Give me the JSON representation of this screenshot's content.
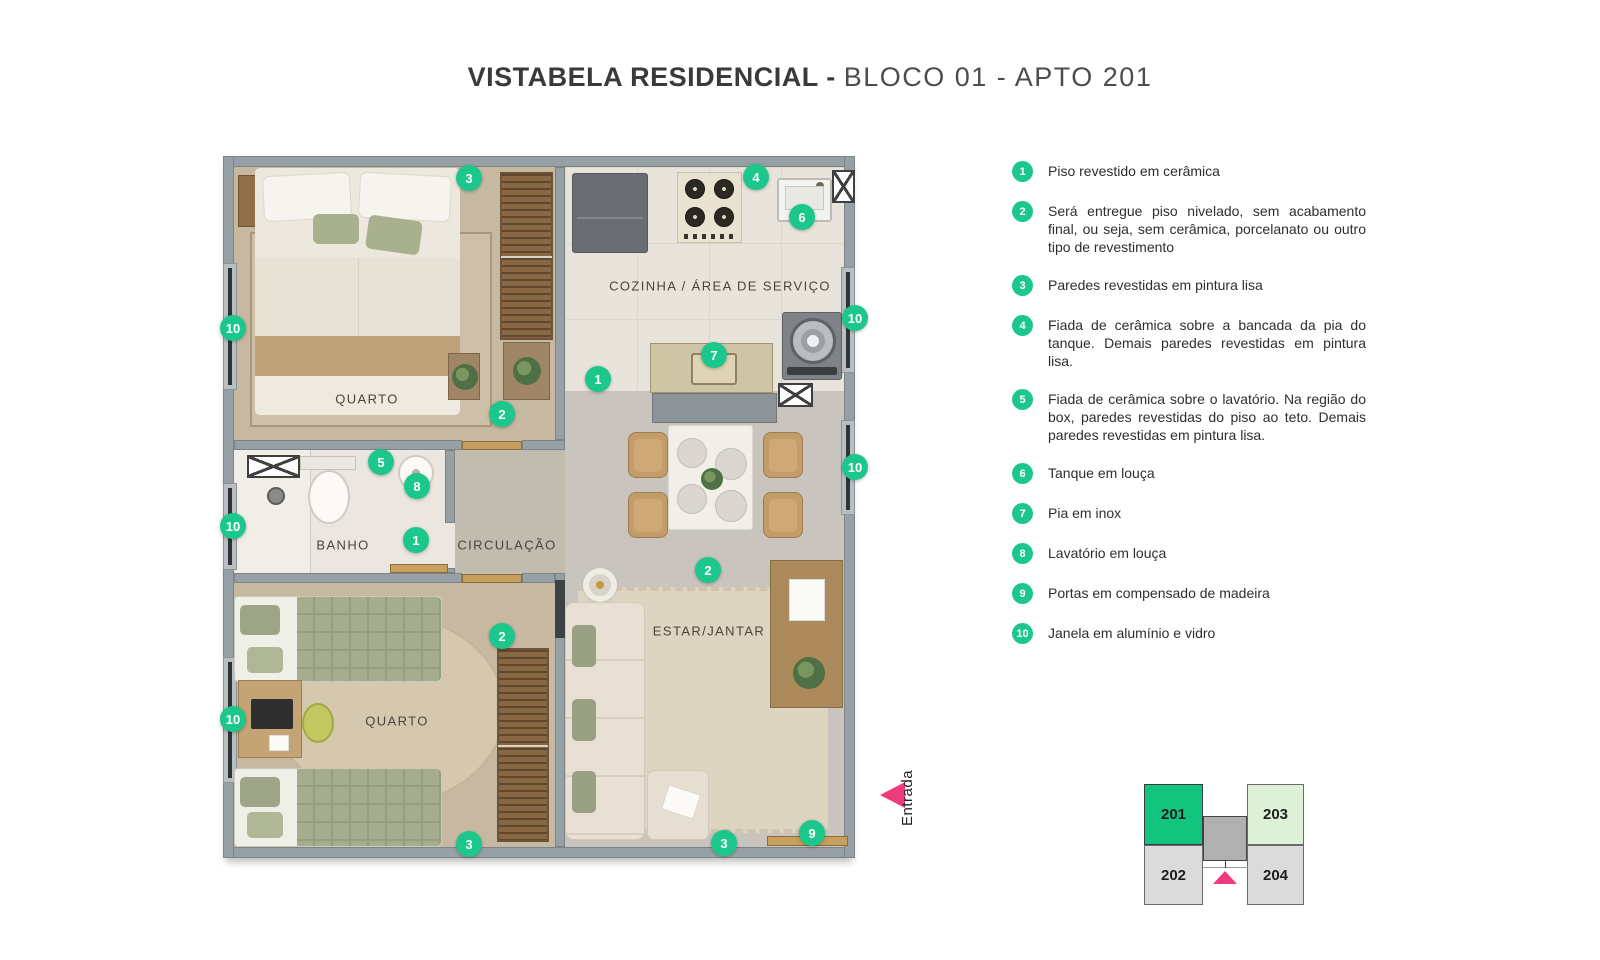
{
  "title": {
    "main": "VISTABELA RESIDENCIAL -",
    "sub": "BLOCO 01 - APTO 201"
  },
  "colors": {
    "accent_green": "#1cc78c",
    "accent_pink": "#ee3b7e",
    "unit_active": "#13c47f",
    "unit_soft": "#def0d5"
  },
  "plan": {
    "entrance_label": "Entrada",
    "rooms": [
      {
        "label": "QUARTO",
        "x": 144,
        "y": 243
      },
      {
        "label": "COZINHA / ÁREA DE SERVIÇO",
        "x": 497,
        "y": 130
      },
      {
        "label": "BANHO",
        "x": 120,
        "y": 389
      },
      {
        "label": "CIRCULAÇÃO",
        "x": 284,
        "y": 389
      },
      {
        "label": "QUARTO",
        "x": 174,
        "y": 565
      },
      {
        "label": "ESTAR/JANTAR",
        "x": 486,
        "y": 475
      }
    ],
    "badges": [
      {
        "n": "3",
        "x": 246,
        "y": 22
      },
      {
        "n": "4",
        "x": 533,
        "y": 21
      },
      {
        "n": "6",
        "x": 579,
        "y": 61
      },
      {
        "n": "10",
        "x": 632,
        "y": 162
      },
      {
        "n": "7",
        "x": 491,
        "y": 199
      },
      {
        "n": "1",
        "x": 375,
        "y": 223
      },
      {
        "n": "2",
        "x": 279,
        "y": 258
      },
      {
        "n": "10",
        "x": 10,
        "y": 172
      },
      {
        "n": "5",
        "x": 158,
        "y": 306
      },
      {
        "n": "8",
        "x": 194,
        "y": 330
      },
      {
        "n": "10",
        "x": 10,
        "y": 370
      },
      {
        "n": "1",
        "x": 193,
        "y": 384
      },
      {
        "n": "10",
        "x": 632,
        "y": 311
      },
      {
        "n": "2",
        "x": 485,
        "y": 414
      },
      {
        "n": "2",
        "x": 279,
        "y": 480
      },
      {
        "n": "10",
        "x": 10,
        "y": 563
      },
      {
        "n": "3",
        "x": 246,
        "y": 688
      },
      {
        "n": "3",
        "x": 501,
        "y": 687
      },
      {
        "n": "9",
        "x": 589,
        "y": 677
      }
    ]
  },
  "legend": {
    "items": [
      {
        "n": "1",
        "text": "Piso revestido em cerâmica"
      },
      {
        "n": "2",
        "text": "Será entregue piso nivelado, sem acabamento final, ou seja, sem cerâmica, porcelanato ou outro tipo de revestimento"
      },
      {
        "n": "3",
        "text": "Paredes revestidas em pintura lisa"
      },
      {
        "n": "4",
        "text": "Fiada de cerâmica sobre a bancada da pia do tanque. Demais paredes revestidas em pintura lisa."
      },
      {
        "n": "5",
        "text": "Fiada de cerâmica sobre o lavatório. Na região do box, paredes revestidas do piso ao teto. Demais paredes revestidas em pintura lisa."
      },
      {
        "n": "6",
        "text": "Tanque em louça"
      },
      {
        "n": "7",
        "text": "Pia em inox"
      },
      {
        "n": "8",
        "text": "Lavatório em louça"
      },
      {
        "n": "9",
        "text": "Portas em compensado de madeira"
      },
      {
        "n": "10",
        "text": "Janela em alumínio e vidro"
      }
    ]
  },
  "unit_map": {
    "units": [
      "201",
      "202",
      "203",
      "204"
    ]
  }
}
